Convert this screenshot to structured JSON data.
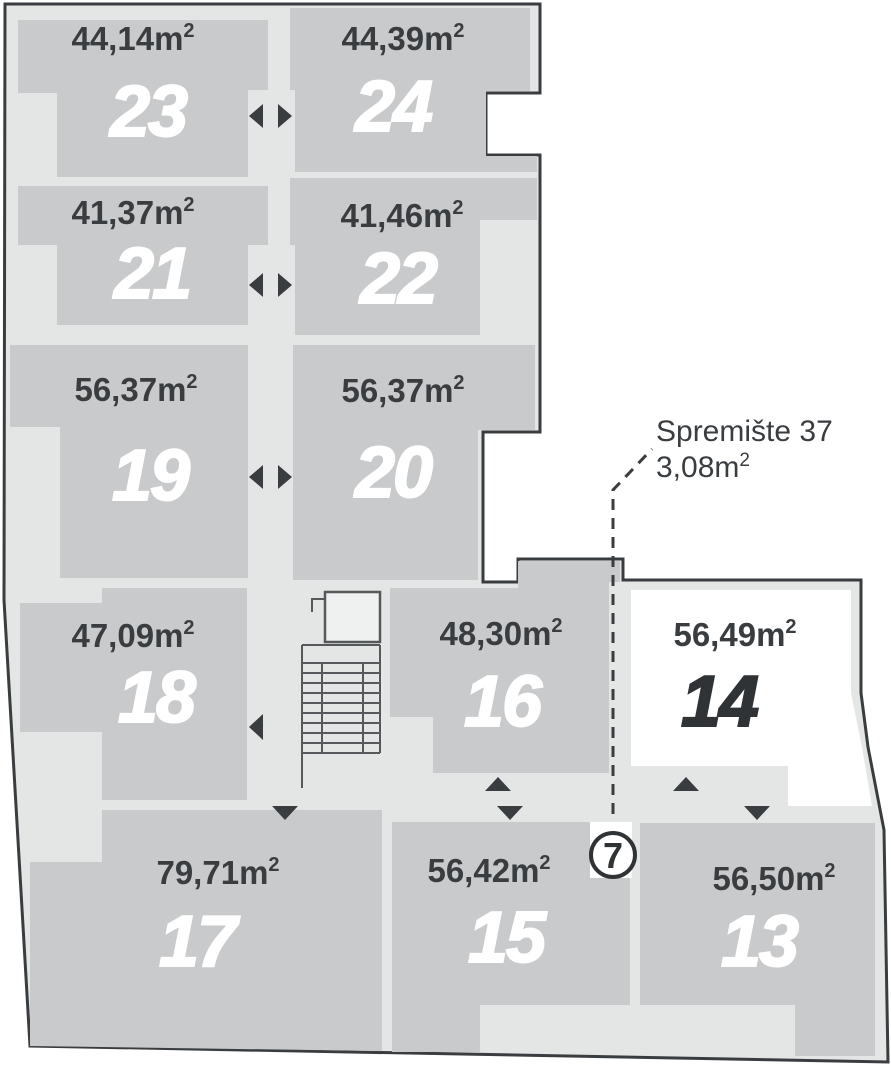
{
  "labels": {
    "meter": "m",
    "sup": "2"
  },
  "storage_callout": {
    "name": "Spremište 37",
    "area": "3,08"
  },
  "marker": {
    "label": "7"
  },
  "units": [
    {
      "number": "23",
      "area": "44,14",
      "highlighted": false
    },
    {
      "number": "24",
      "area": "44,39",
      "highlighted": false
    },
    {
      "number": "21",
      "area": "41,37",
      "highlighted": false
    },
    {
      "number": "22",
      "area": "41,46",
      "highlighted": false
    },
    {
      "number": "19",
      "area": "56,37",
      "highlighted": false
    },
    {
      "number": "20",
      "area": "56,37",
      "highlighted": false
    },
    {
      "number": "18",
      "area": "47,09",
      "highlighted": false
    },
    {
      "number": "16",
      "area": "48,30",
      "highlighted": false
    },
    {
      "number": "14",
      "area": "56,49",
      "highlighted": true
    },
    {
      "number": "17",
      "area": "79,71",
      "highlighted": false
    },
    {
      "number": "15",
      "area": "56,42",
      "highlighted": false
    },
    {
      "number": "13",
      "area": "56,50",
      "highlighted": false
    }
  ],
  "colors": {
    "outline": "#3a3d40",
    "unit_fill": "#c9cacb",
    "common_area_fill": "#e4e5e5",
    "highlight_unit_fill": "#ffffff",
    "unit_number_text": "#ffffff",
    "area_text": "#3a3d40",
    "highlight_number_text": "#303336"
  }
}
